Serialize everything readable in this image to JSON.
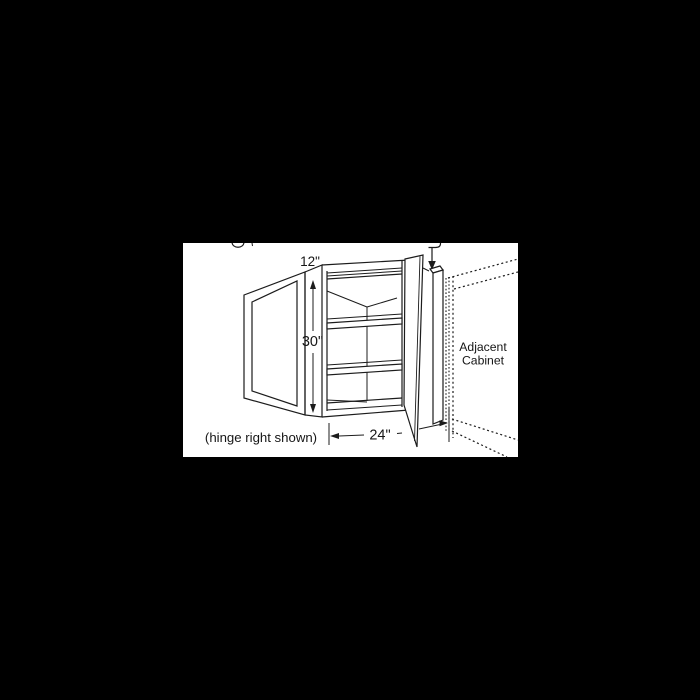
{
  "window": {
    "background_color": "#000000"
  },
  "panel": {
    "background_color": "#ffffff",
    "line_color": "#1c1c1c"
  },
  "diagram": {
    "type": "blind-corner-wall-cabinet-line-drawing",
    "labels": {
      "depth": "12\"",
      "height": "30\"",
      "width": "24\"",
      "hinge_note": "(hinge right shown)",
      "adjacent_cabinet_line1": "Adjacent",
      "adjacent_cabinet_line2": "Cabinet"
    }
  }
}
